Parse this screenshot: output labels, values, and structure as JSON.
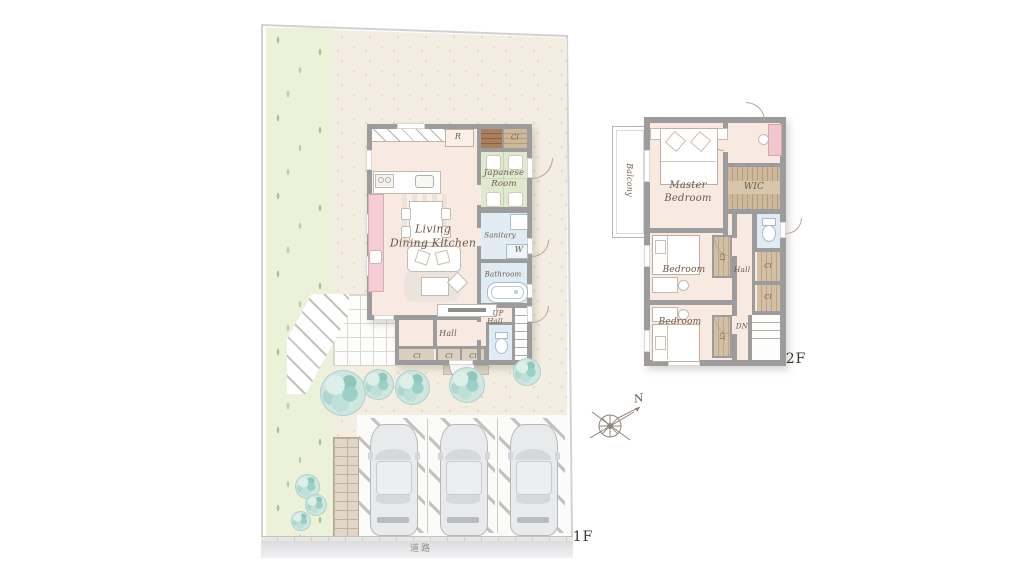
{
  "site": {
    "road_label": "道路",
    "floor_label": "1F"
  },
  "floor1": {
    "rooms": {
      "ldk": "Living\nDining Kitchen",
      "japanese_room": "Japanese\nRoom",
      "sanitary": "Sanitary",
      "washer": "W",
      "bathroom": "Bathroom",
      "fridge": "R",
      "closet_top": "Cl",
      "up": "UP",
      "up_hall": "Hall",
      "hall": "Hall",
      "closet_hall": "Cl",
      "closet_entry1": "Cl",
      "closet_entry2": "Cl"
    }
  },
  "floor2": {
    "floor_label": "2F",
    "rooms": {
      "balcony": "Balcony",
      "master_bedroom": "Master\nBedroom",
      "wic": "WIC",
      "hall": "Hall",
      "bedroom1": "Bedroom",
      "bedroom2": "Bedroom",
      "down": "DN",
      "closet_hall1": "Cl",
      "closet_hall2": "Cl",
      "closet_bedroom1": "Cl",
      "closet_bedroom2": "Cl"
    }
  },
  "compass": {
    "north": "N"
  },
  "palette": {
    "wall": "#9c9c9c",
    "room": "#f8e9e1",
    "tatami": "#dfe9ce",
    "water": "#e1ebf3",
    "shelf": "#cdb89c",
    "lawn": "#ecf1da",
    "gravel": "#f3eee1",
    "accent_pink": "#f5cdd5",
    "tree": "#9ecfc6",
    "label": "#6b5a4c"
  }
}
